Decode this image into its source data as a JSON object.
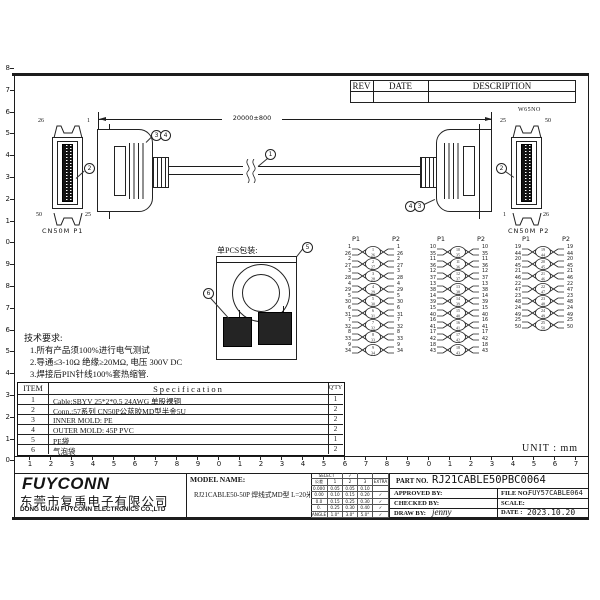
{
  "rev_table": {
    "rev": "REV",
    "date": "DATE",
    "description": "DESCRIPTION"
  },
  "dimension": {
    "label": "20000±800"
  },
  "connectors": {
    "left": {
      "name": "CN50M P1",
      "pin_tl": "26",
      "pin_tr": "1",
      "pin_bl": "50",
      "pin_br": "25"
    },
    "right": {
      "name": "CN50M P2",
      "tag": "W65NO",
      "pin_tl": "25",
      "pin_tr": "50",
      "pin_bl": "1",
      "pin_br": "26"
    }
  },
  "callouts": {
    "cable": "1",
    "connector": "2",
    "inner_mold": "3",
    "outer_mold": "4",
    "pe_bag": "5",
    "bubble_bag": "6"
  },
  "pin_map": {
    "p1": "P1",
    "p2": "P2",
    "groups": [
      {
        "pairs": [
          [
            1,
            26
          ],
          [
            2,
            27
          ],
          [
            3,
            28
          ],
          [
            4,
            29
          ],
          [
            5,
            30
          ],
          [
            6,
            31
          ],
          [
            7,
            32
          ],
          [
            8,
            33
          ],
          [
            9,
            34
          ]
        ]
      },
      {
        "pairs": [
          [
            10,
            35
          ],
          [
            11,
            36
          ],
          [
            12,
            37
          ],
          [
            13,
            38
          ],
          [
            14,
            39
          ],
          [
            15,
            40
          ],
          [
            16,
            41
          ],
          [
            17,
            42
          ],
          [
            18,
            43
          ]
        ]
      },
      {
        "pairs": [
          [
            19,
            44
          ],
          [
            20,
            45
          ],
          [
            21,
            46
          ],
          [
            22,
            47
          ],
          [
            23,
            48
          ],
          [
            24,
            49
          ],
          [
            25,
            50
          ]
        ]
      }
    ]
  },
  "packaging": {
    "title": "单PCS包装:"
  },
  "tech_notes": {
    "title": "技术要求:",
    "lines": [
      "1.所有产品须100%进行电气测试",
      "2.导通≤3-10Ω  绝缘≥20MΩ, 电压 300V DC",
      "3.焊接后PIN针线100%套热缩管."
    ]
  },
  "spec_table": {
    "headers": [
      "ITEM",
      "Specification",
      "Q'TY"
    ],
    "rows": [
      [
        "1",
        "Cable:SBYV 25*2*0.5 24AWG 单股裸铜",
        "1"
      ],
      [
        "2",
        "Conn.:57系列 CN50P公蓝胶MD型半金5U",
        "2"
      ],
      [
        "3",
        "INNER MOLD: PE",
        "2"
      ],
      [
        "4",
        "OUTER MOLD: 45P PVC",
        "2"
      ],
      [
        "5",
        "PE袋",
        "1"
      ],
      [
        "6",
        "气泡袋",
        "2"
      ]
    ]
  },
  "unit_label": "UNIT : mm",
  "company": {
    "logo": "FUYCONN",
    "name_cn": "东莞市复禹电子有限公司",
    "name_en": "DONG GUAN FUYCONN ELECTRONICS CO.,LTD"
  },
  "model": {
    "label": "MODEL NAME:",
    "value": "RJ21CABLE50-50P 焊线式MD型  L=20米"
  },
  "tolerance": {
    "select": "SELECT",
    "check": "✓",
    "grade_label": "公差",
    "cols": [
      "1",
      "2",
      "3",
      "EXTRA"
    ],
    "rows": [
      [
        "0.000",
        "0.05",
        "0.05",
        "0.10",
        ""
      ],
      [
        "0.00",
        "0.10",
        "0.15",
        "0.20",
        "✓"
      ],
      [
        "0.0",
        "0.15",
        "0.25",
        "0.30",
        "✓"
      ],
      [
        "0.",
        "0.25",
        "0.30",
        "0.40",
        "✓"
      ],
      [
        "ANGLE",
        "1.0°",
        "3.0°",
        "5.0°",
        "✓"
      ]
    ]
  },
  "info": {
    "part_label": "PART NO.",
    "part_no": "RJ21CABLE50PBC0064",
    "approved": "APPROVED BY:",
    "file": "FILE NO.",
    "file_no": "FUY57CABLE064",
    "checked": "CHECKED BY:",
    "scale": "SCALE:",
    "drawn": "DRAW BY:",
    "drawn_by": "jenny",
    "date_label": "DATE :",
    "date": "2023.10.20"
  },
  "rulers": {
    "left": [
      "8",
      "7",
      "6",
      "5",
      "4",
      "3",
      "2",
      "1",
      "0",
      "9",
      "8",
      "7",
      "6",
      "5",
      "4",
      "3",
      "2",
      "1",
      "0"
    ],
    "bottom": [
      "1",
      "2",
      "3",
      "4",
      "5",
      "6",
      "7",
      "8",
      "9",
      "0",
      "1",
      "2",
      "3",
      "4",
      "5",
      "6",
      "7",
      "8",
      "9",
      "0",
      "1",
      "2",
      "3",
      "4",
      "5",
      "6",
      "7"
    ]
  }
}
